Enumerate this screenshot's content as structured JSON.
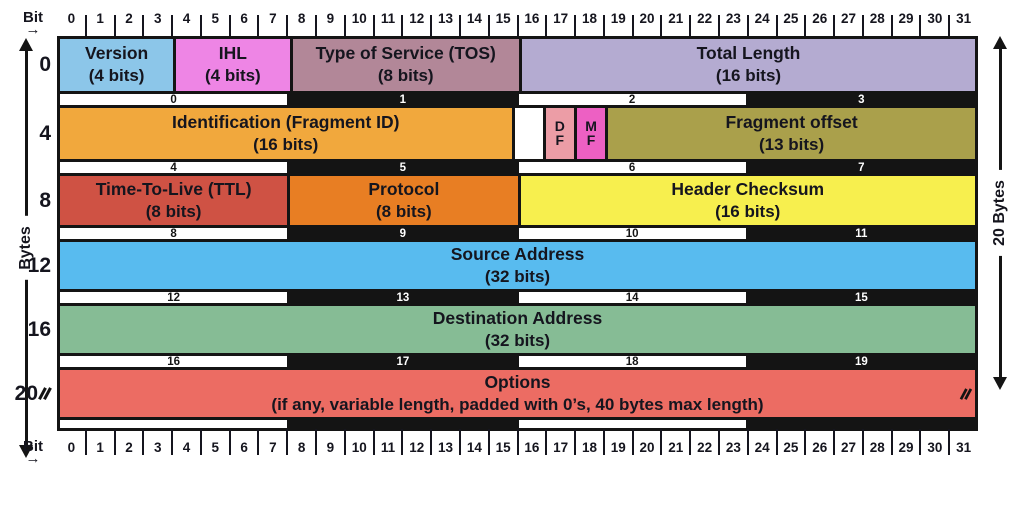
{
  "axis": {
    "bit_label": "Bit",
    "bit_arrow": "→",
    "bytes_axis_label": "Bytes",
    "right_axis_label": "20 Bytes",
    "bit_numbers": [
      "0",
      "1",
      "2",
      "3",
      "4",
      "5",
      "6",
      "7",
      "8",
      "9",
      "10",
      "11",
      "12",
      "13",
      "14",
      "15",
      "16",
      "17",
      "18",
      "19",
      "20",
      "21",
      "22",
      "23",
      "24",
      "25",
      "26",
      "27",
      "28",
      "29",
      "30",
      "31"
    ]
  },
  "colors": {
    "version": "#8CC6E9",
    "ihl": "#EE85E5",
    "tos": "#B28798",
    "total_length": "#B4ABD1",
    "identification": "#F1A83D",
    "reserved": "#FFFFFF",
    "df": "#EC9DA6",
    "mf": "#ED60C3",
    "fragment_offset": "#AAA04B",
    "ttl": "#CF5244",
    "protocol": "#E87E23",
    "header_checksum": "#F7EF4E",
    "source_address": "#58BBEF",
    "destination_address": "#86BC95",
    "options": "#EC6C63",
    "strip_dark": "#141414"
  },
  "rows": [
    {
      "byte_label": "0",
      "fields": [
        {
          "name": "Version",
          "size": "(4 bits)"
        },
        {
          "name": "IHL",
          "size": "(4 bits)"
        },
        {
          "name": "Type of Service (TOS)",
          "size": "(8 bits)"
        },
        {
          "name": "Total Length",
          "size": "(16 bits)"
        }
      ],
      "octets": [
        "0",
        "1",
        "2",
        "3"
      ]
    },
    {
      "byte_label": "4",
      "fields": [
        {
          "name": "Identification  (Fragment ID)",
          "size": "(16 bits)"
        },
        {
          "name": "",
          "size": ""
        },
        {
          "name": "D",
          "size": "F"
        },
        {
          "name": "M",
          "size": "F"
        },
        {
          "name": "Fragment offset",
          "size": "(13 bits)"
        }
      ],
      "octets": [
        "4",
        "5",
        "6",
        "7"
      ]
    },
    {
      "byte_label": "8",
      "fields": [
        {
          "name": "Time-To-Live (TTL)",
          "size": "(8 bits)"
        },
        {
          "name": "Protocol",
          "size": "(8 bits)"
        },
        {
          "name": "Header Checksum",
          "size": "(16 bits)"
        }
      ],
      "octets": [
        "8",
        "9",
        "10",
        "11"
      ]
    },
    {
      "byte_label": "12",
      "fields": [
        {
          "name": "Source Address",
          "size": "(32 bits)"
        }
      ],
      "octets": [
        "12",
        "13",
        "14",
        "15"
      ]
    },
    {
      "byte_label": "16",
      "fields": [
        {
          "name": "Destination Address",
          "size": "(32 bits)"
        }
      ],
      "octets": [
        "16",
        "17",
        "18",
        "19"
      ]
    },
    {
      "byte_label": "20",
      "fields": [
        {
          "name": "Options",
          "size": "(if any, variable length, padded with 0’s, 40 bytes max length)"
        }
      ],
      "octets": [
        "",
        "",
        "",
        ""
      ]
    }
  ]
}
